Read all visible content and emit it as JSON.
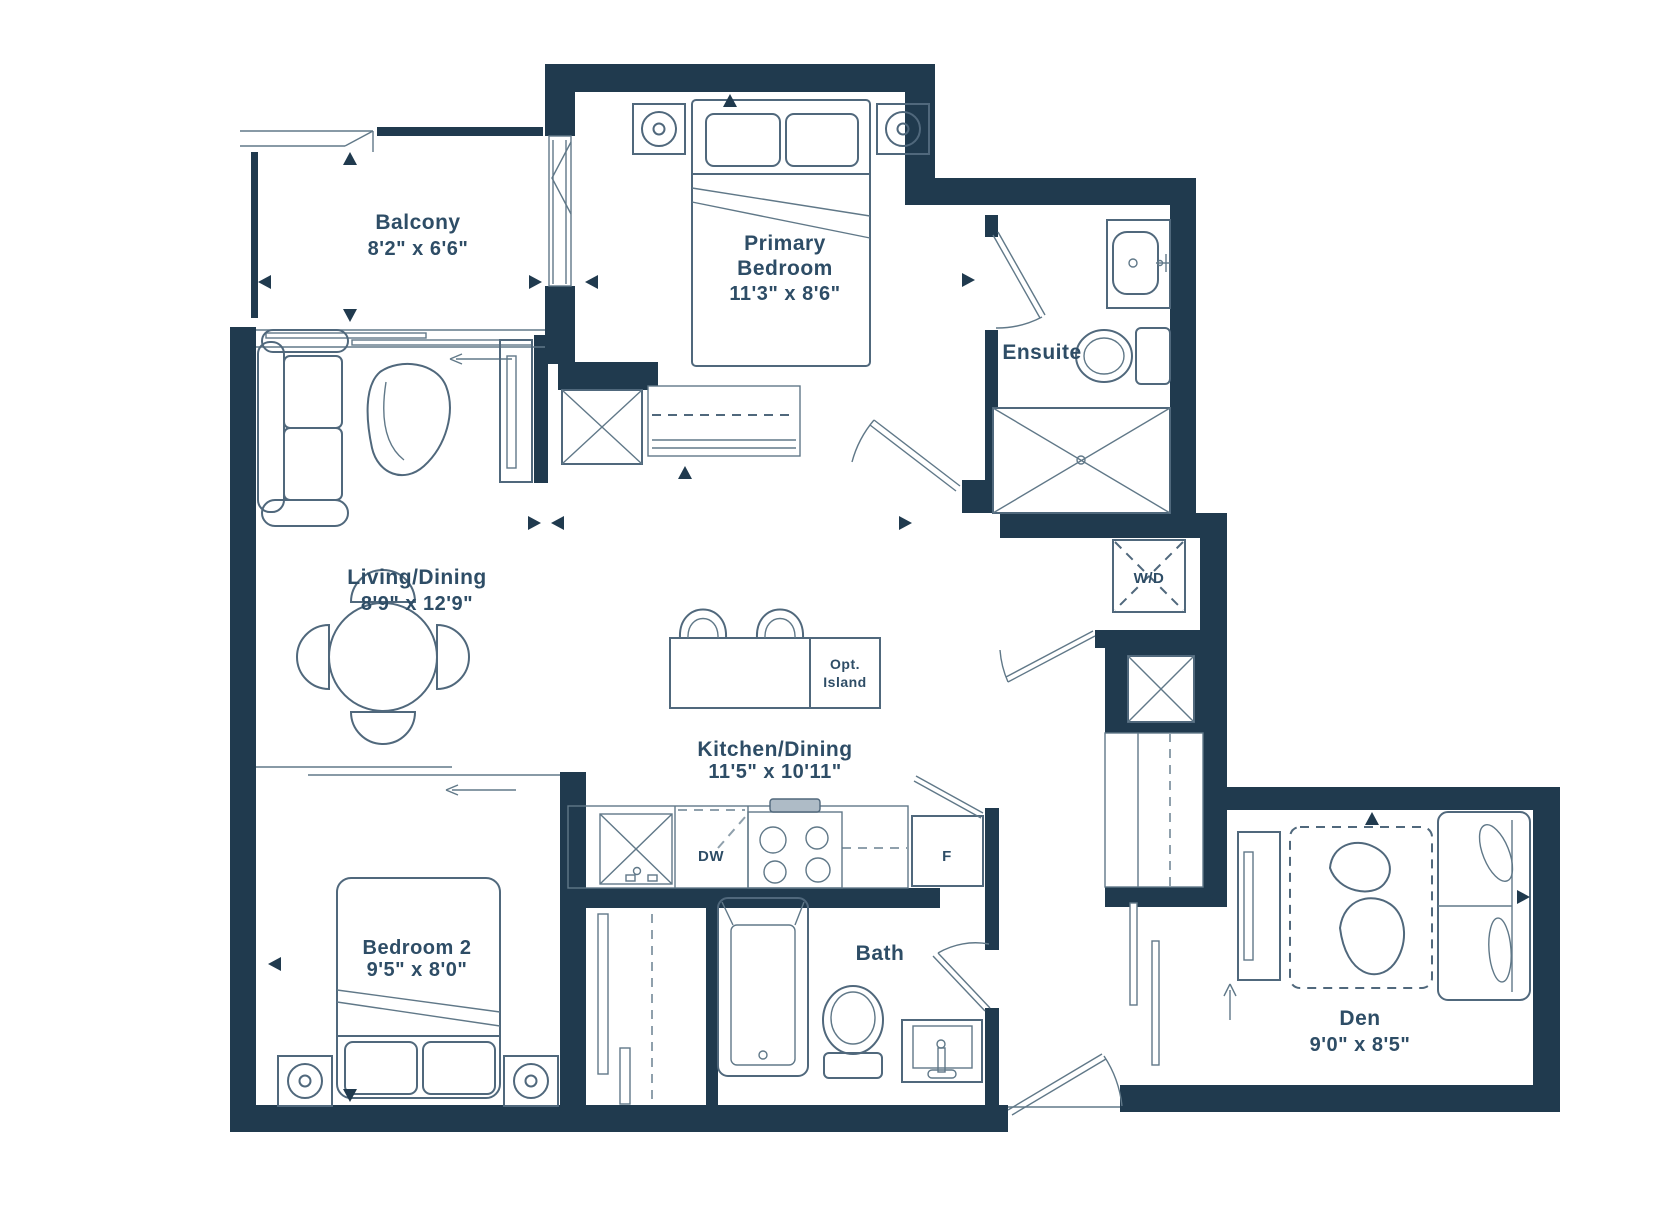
{
  "floorplan": {
    "colors": {
      "wall": "#203a4e",
      "line": "#50687c",
      "text": "#2e4d66",
      "background": "#ffffff"
    },
    "rooms": {
      "balcony": {
        "name": "Balcony",
        "dims": "8'2\" x 6'6\""
      },
      "primary_bedroom": {
        "name_line1": "Primary",
        "name_line2": "Bedroom",
        "dims": "11'3\" x 8'6\""
      },
      "ensuite": {
        "name": "Ensuite"
      },
      "living_dining": {
        "name": "Living/Dining",
        "dims": "8'9\" x 12'9\""
      },
      "kitchen_dining": {
        "name": "Kitchen/Dining",
        "dims": "11'5\" x 10'11\""
      },
      "bedroom_2": {
        "name": "Bedroom 2",
        "dims": "9'5\" x 8'0\""
      },
      "bath": {
        "name": "Bath"
      },
      "den": {
        "name": "Den",
        "dims": "9'0\" x 8'5\""
      }
    },
    "appliances": {
      "washer_dryer": "W/D",
      "dishwasher": "DW",
      "fridge": "F",
      "island_line1": "Opt.",
      "island_line2": "Island"
    }
  }
}
